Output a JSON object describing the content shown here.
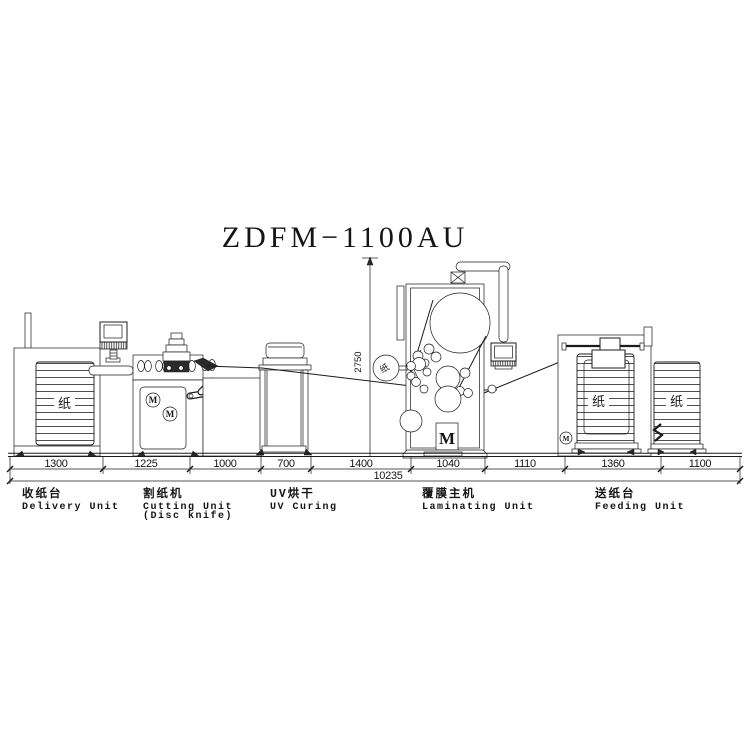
{
  "title": "ZDFM−1100AU",
  "dims": {
    "segments": [
      "1300",
      "1225",
      "1000",
      "700",
      "1400",
      "1040",
      "1110",
      "1360",
      "1100"
    ],
    "total": "10235",
    "height": "2750"
  },
  "labels": {
    "delivery": {
      "cn": "收纸台",
      "en": "Delivery Unit"
    },
    "cutting": {
      "cn": "割纸机",
      "en": "Cutting Unit",
      "en2": "(Disc knife)"
    },
    "uv": {
      "cn": "UV烘干",
      "en": "UV Curing"
    },
    "laminating": {
      "cn": "覆膜主机",
      "en": "Laminating Unit"
    },
    "feeding": {
      "cn": "送纸台",
      "en": "Feeding Unit"
    }
  },
  "glyphs": {
    "paper": "纸",
    "motor": "M"
  }
}
